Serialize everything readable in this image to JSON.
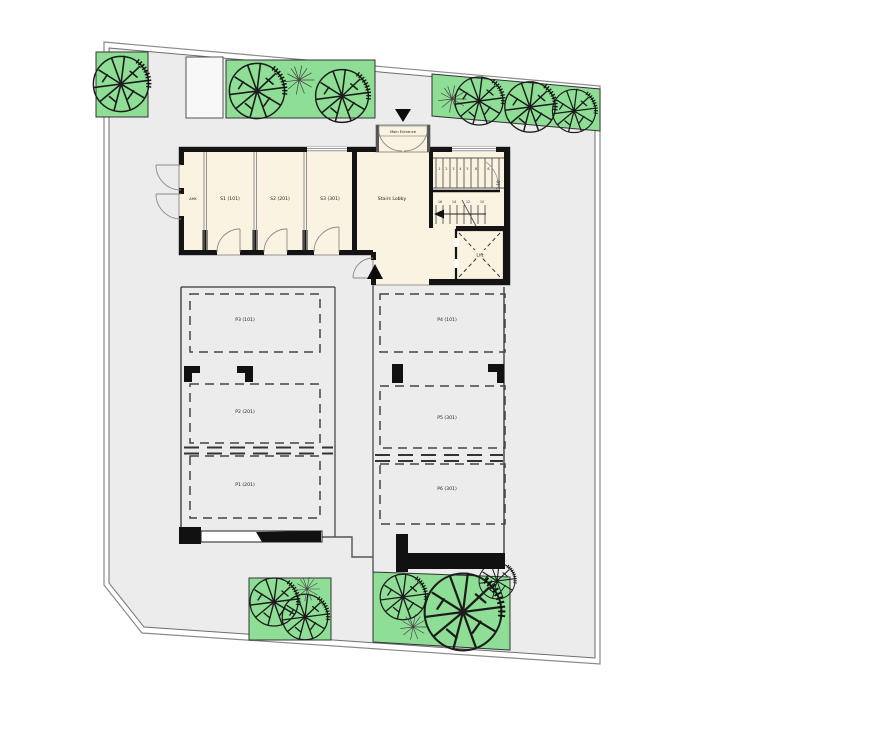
{
  "building": {
    "entrance_label": "Main Entrance",
    "rooms": {
      "ahk": "AHK",
      "s1": "S1 (101)",
      "s2": "S2 (201)",
      "s3": "S3 (301)",
      "lobby": "Stairs Lobby",
      "lift": "Lift"
    },
    "stairs": {
      "up": [
        "1",
        "2",
        "3",
        "4",
        "5",
        "6",
        "8"
      ],
      "down": [
        "16",
        "14",
        "12",
        "10"
      ],
      "dim": "2.10"
    }
  },
  "parking": {
    "p1": "P1 (201)",
    "p2": "P2 (201)",
    "p3": "P3 (101)",
    "p4": "P4 (101)",
    "p5": "P5 (301)",
    "p6": "P6 (301)"
  },
  "colors": {
    "site": "#ececec",
    "room": "#faf3e1",
    "planter": "#8ede96",
    "wall": "#141414"
  }
}
